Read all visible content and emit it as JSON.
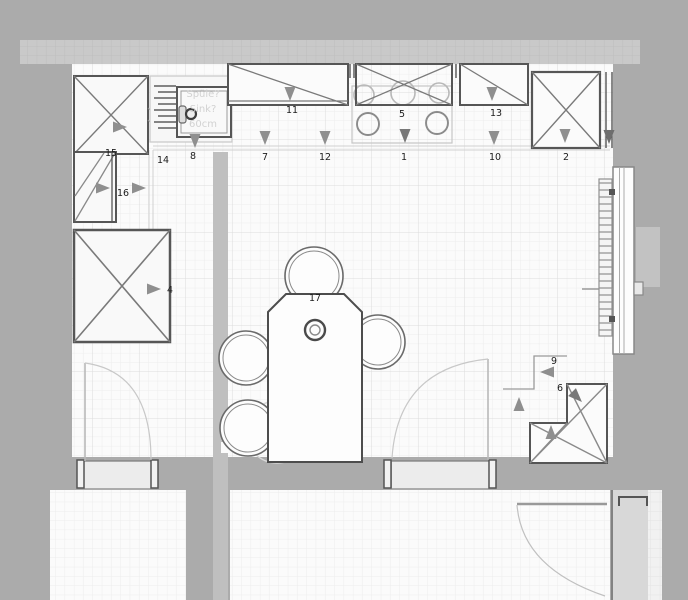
{
  "plan": {
    "title": "kitchen-floor-plan",
    "item_labels": {
      "i1": "1",
      "i2": "2",
      "i4": "4",
      "i5": "5",
      "i6": "6",
      "i7": "7",
      "i8": "8",
      "i9": "9",
      "i10": "10",
      "i11": "11",
      "i12": "12",
      "i13": "13",
      "i14": "14",
      "i15": "15",
      "i16": "16",
      "i17": "17"
    },
    "sink_note": {
      "line1": "Spüle?",
      "line2": "Sink?",
      "line3": "60cm"
    },
    "colors": {
      "wall_gray": "#ababab",
      "room_white": "#fbfbfb",
      "outline_dark": "#565656",
      "arrow_gray": "#8f8f8f",
      "sheet_gray": "#c9c9c9"
    }
  }
}
